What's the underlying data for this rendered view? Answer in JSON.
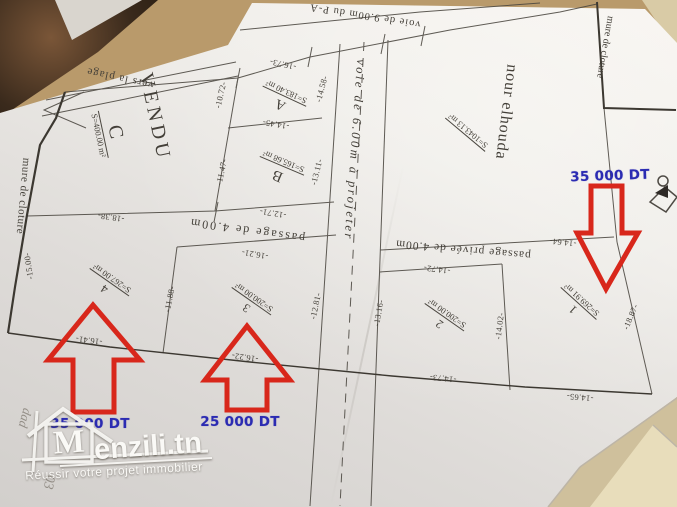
{
  "plan": {
    "roads": {
      "top_road": "voie de 9.00m du P-A",
      "beach_direction": "vers la plage",
      "central_road": "voie de 6.00m à projeter",
      "middle_passage": "passage de 4.00m",
      "private_passage": "passage privée de 4.00m"
    },
    "walls": {
      "left": "mure de cloture",
      "right": "mure de cloture"
    },
    "parcels": [
      {
        "name": "C",
        "area": "S=400.00 m²",
        "status": "VENDU"
      },
      {
        "name": "A",
        "area": "S=183.40 m²"
      },
      {
        "name": "B",
        "area": "S=165.68 m²"
      },
      {
        "name": "nour elhouda",
        "area": "S=1043.13 m²"
      },
      {
        "name": "4",
        "area": "S=267.00 m²"
      },
      {
        "name": "3",
        "area": "S=200.00 m²"
      },
      {
        "name": "2",
        "area": "S=200.00 m²"
      },
      {
        "name": "1",
        "area": "S=269.91 m²"
      }
    ],
    "measurements": [
      "-16.73-",
      "-10.72-",
      "-14.58-",
      "-14.45-",
      "-11.47-",
      "-13.11-",
      "-15.00-",
      "-18.38-",
      "-12.71-",
      "-16.21-",
      "-11.88-",
      "-16.41-",
      "-16.22-",
      "-12.81-",
      "-13.16-",
      "-14.72-",
      "-14.64-",
      "-14.02-",
      "-14.73-",
      "-14.65-",
      "-18.87-"
    ]
  },
  "annotations": {
    "prices": [
      "35 000 DT",
      "35 000 DT",
      "25 000 DT"
    ],
    "handwriting": [
      "dad",
      "03"
    ],
    "price_color": "#2b2bb2",
    "arrow_color": "#d8271b"
  },
  "watermark": {
    "logo_letter": "M",
    "brand_suffix": "enzili.tn",
    "tagline": "Réussir votre projet immobilier"
  }
}
